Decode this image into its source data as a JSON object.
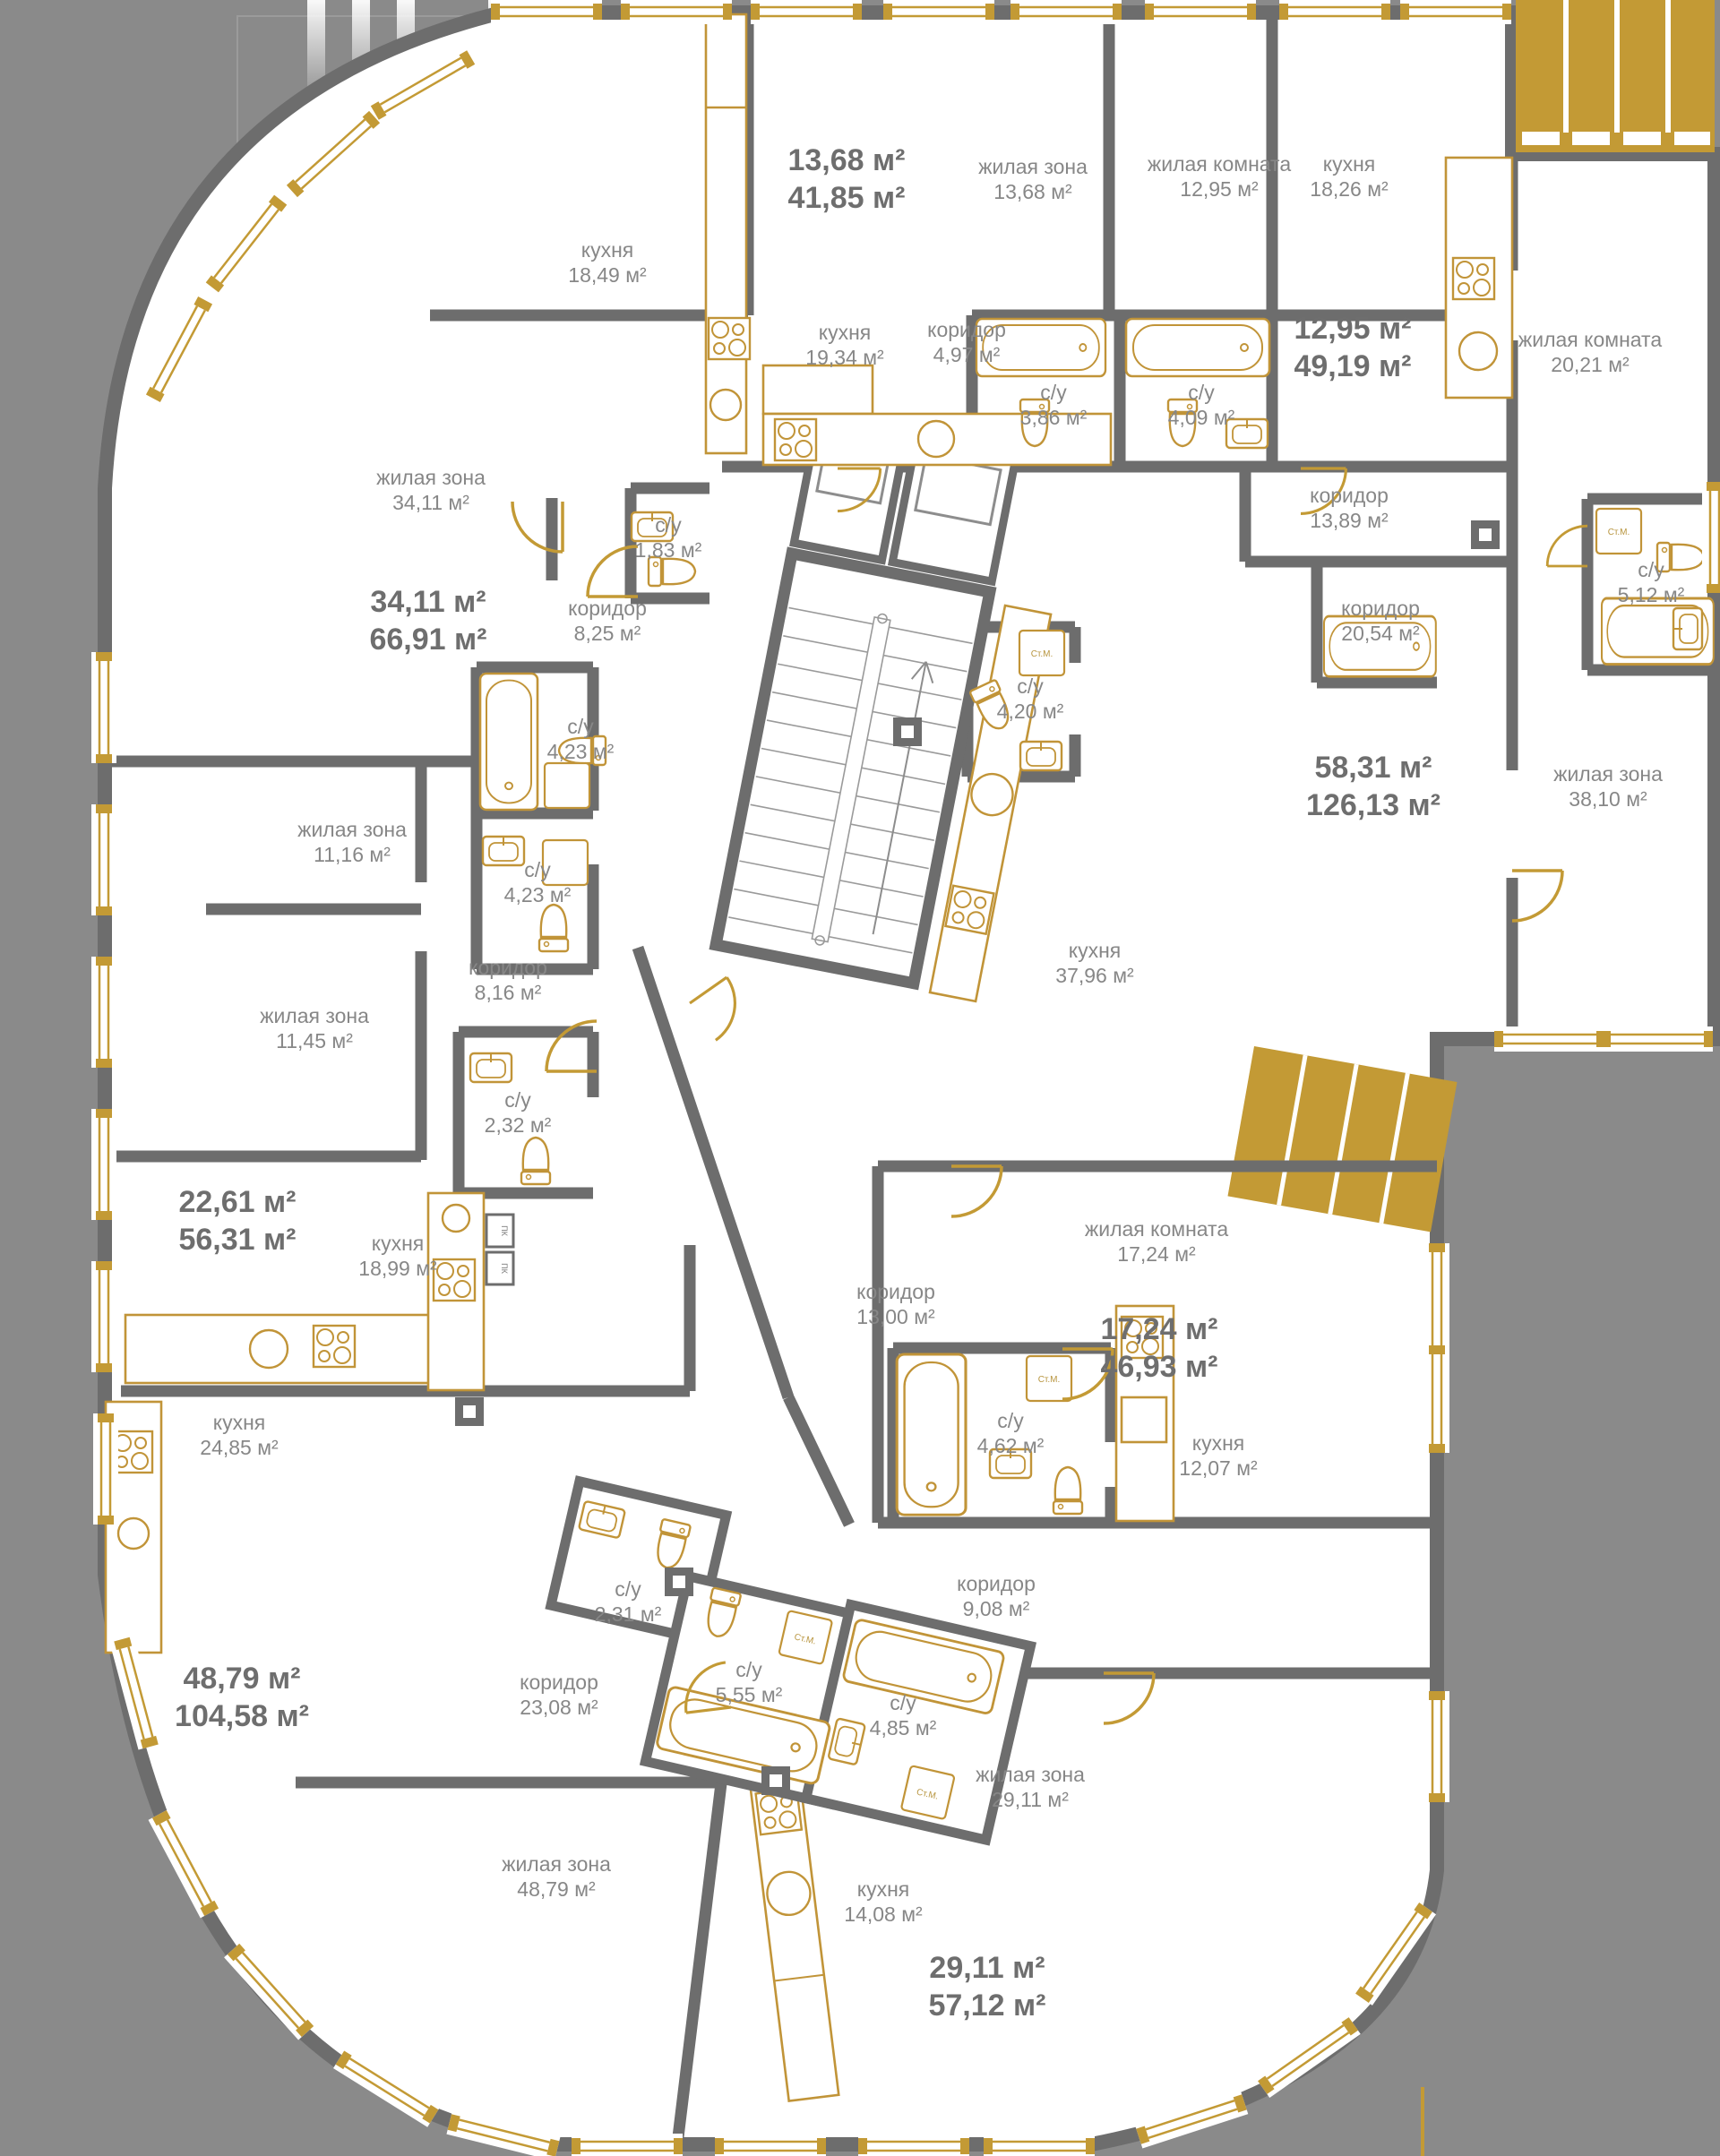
{
  "plan_title": "floor-plan",
  "colors": {
    "background": "#8a8a8a",
    "walls": "#6d6d6d",
    "floor": "#ffffff",
    "accent_gold": "#c39a35",
    "room_text": "#878787",
    "apartment_text": "#6e6e6e"
  },
  "fixtures": {
    "washer_label": "Ст.М.",
    "duct_label": "ПК"
  },
  "apartments": [
    {
      "living": "13,68 м²",
      "total": "41,85 м²"
    },
    {
      "living": "12,95 м²",
      "total": "49,19 м²"
    },
    {
      "living": "34,11 м²",
      "total": "66,91 м²"
    },
    {
      "living": "58,31 м²",
      "total": "126,13 м²"
    },
    {
      "living": "22,61 м²",
      "total": "56,31 м²"
    },
    {
      "living": "17,24 м²",
      "total": "46,93 м²"
    },
    {
      "living": "48,79 м²",
      "total": "104,58 м²"
    },
    {
      "living": "29,11 м²",
      "total": "57,12 м²"
    }
  ],
  "rooms": [
    {
      "name": "кухня",
      "area": "18,49 м²"
    },
    {
      "name": "кухня",
      "area": "19,34 м²"
    },
    {
      "name": "жилая зона",
      "area": "13,68 м²"
    },
    {
      "name": "коридор",
      "area": "4,97 м²"
    },
    {
      "name": "с/у",
      "area": "3,86 м²"
    },
    {
      "name": "с/у",
      "area": "4,09 м²"
    },
    {
      "name": "жилая комната",
      "area": "12,95 м²"
    },
    {
      "name": "кухня",
      "area": "18,26 м²"
    },
    {
      "name": "жилая комната",
      "area": "20,21 м²"
    },
    {
      "name": "коридор",
      "area": "13,89 м²"
    },
    {
      "name": "с/у",
      "area": "5,12 м²"
    },
    {
      "name": "коридор",
      "area": "20,54 м²"
    },
    {
      "name": "жилая зона",
      "area": "34,11 м²"
    },
    {
      "name": "с/у",
      "area": "1,83 м²"
    },
    {
      "name": "коридор",
      "area": "8,25 м²"
    },
    {
      "name": "с/у",
      "area": "4,20 м²"
    },
    {
      "name": "жилая зона",
      "area": "38,10 м²"
    },
    {
      "name": "с/у",
      "area": "4,23 м²"
    },
    {
      "name": "жилая зона",
      "area": "11,16 м²"
    },
    {
      "name": "с/у",
      "area": "4,23 м²"
    },
    {
      "name": "коридор",
      "area": "8,16 м²"
    },
    {
      "name": "жилая зона",
      "area": "11,45 м²"
    },
    {
      "name": "кухня",
      "area": "37,96 м²"
    },
    {
      "name": "с/у",
      "area": "2,32 м²"
    },
    {
      "name": "кухня",
      "area": "18,99 м²"
    },
    {
      "name": "жилая комната",
      "area": "17,24 м²"
    },
    {
      "name": "коридор",
      "area": "13,00 м²"
    },
    {
      "name": "кухня",
      "area": "24,85 м²"
    },
    {
      "name": "с/у",
      "area": "4,62 м²"
    },
    {
      "name": "кухня",
      "area": "12,07 м²"
    },
    {
      "name": "коридор",
      "area": "9,08 м²"
    },
    {
      "name": "с/у",
      "area": "2,31 м²"
    },
    {
      "name": "с/у",
      "area": "5,55 м²"
    },
    {
      "name": "коридор",
      "area": "23,08 м²"
    },
    {
      "name": "с/у",
      "area": "4,85 м²"
    },
    {
      "name": "жилая зона",
      "area": "29,11 м²"
    },
    {
      "name": "жилая зона",
      "area": "48,79 м²"
    },
    {
      "name": "кухня",
      "area": "14,08 м²"
    }
  ]
}
